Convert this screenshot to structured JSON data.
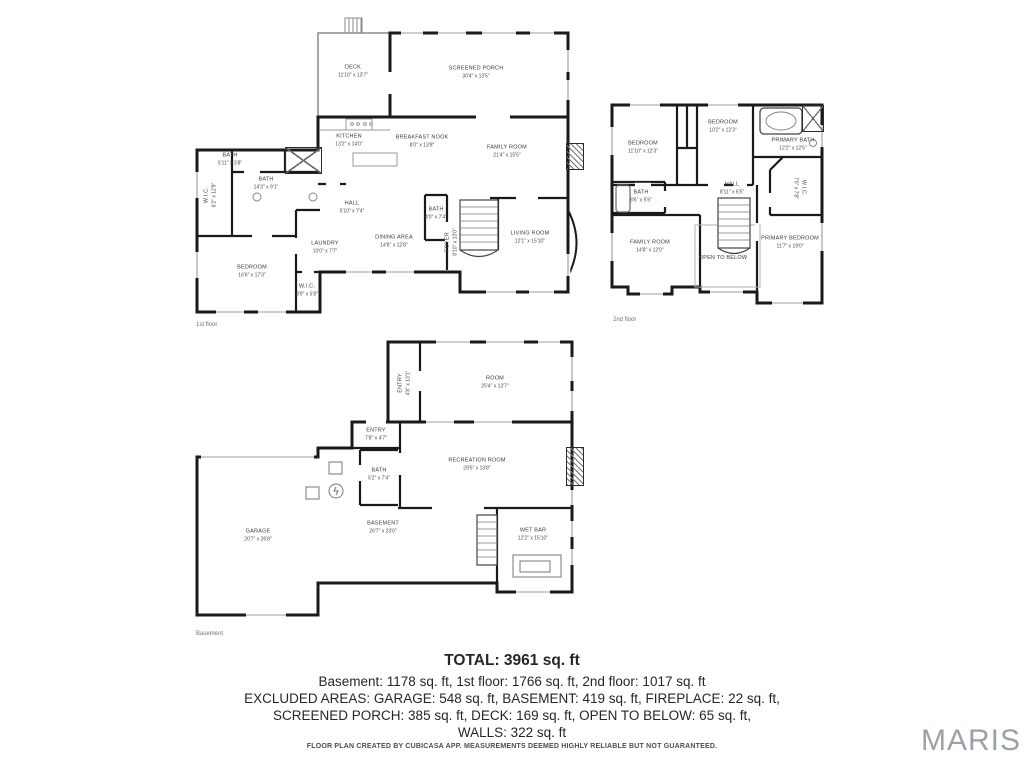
{
  "floors": [
    {
      "label": "1st floor",
      "rooms": [
        {
          "name": "DECK",
          "dims": "11'10\" x 13'7\""
        },
        {
          "name": "SCREENED PORCH",
          "dims": "30'4\" x 13'5\""
        },
        {
          "name": "KITCHEN",
          "dims": "13'2\" x 14'0\""
        },
        {
          "name": "BREAKFAST NOOK",
          "dims": "8'0\" x 13'8\""
        },
        {
          "name": "FAMILY ROOM",
          "dims": "21'4\" x 15'5\""
        },
        {
          "name": "BATH",
          "dims": "5'11\" x 3'8\""
        },
        {
          "name": "BATH",
          "dims": "14'3\" x 9'1\""
        },
        {
          "name": "W.I.C.",
          "dims": "6'2\" x 12'9\""
        },
        {
          "name": "HALL",
          "dims": "5'10\" x 7'4\""
        },
        {
          "name": "LAUNDRY",
          "dims": "10'0\" x 7'7\""
        },
        {
          "name": "DINING AREA",
          "dims": "14'8\" x 12'8\""
        },
        {
          "name": "BATH",
          "dims": "4'0\" x 7'4\""
        },
        {
          "name": "FOYER",
          "dims": "8'10\" x 13'0\""
        },
        {
          "name": "LIVING ROOM",
          "dims": "12'1\" x 15'10\""
        },
        {
          "name": "BEDROOM",
          "dims": "16'6\" x 17'3\""
        },
        {
          "name": "W.I.C.",
          "dims": "3'9\" x 5'8\""
        }
      ]
    },
    {
      "label": "2nd floor",
      "rooms": [
        {
          "name": "BEDROOM",
          "dims": "11'10\" x 12'3\""
        },
        {
          "name": "BEDROOM",
          "dims": "10'2\" x 12'3\""
        },
        {
          "name": "PRIMARY BATH",
          "dims": "12'2\" x 12'5\""
        },
        {
          "name": "W.I.C.",
          "dims": "7'0\" x 7'8\""
        },
        {
          "name": "BATH",
          "dims": "8'6\" x 5'5\""
        },
        {
          "name": "HALL",
          "dims": "8'11\" x 6'5\""
        },
        {
          "name": "FAMILY ROOM",
          "dims": "14'8\" x 12'0\""
        },
        {
          "name": "OPEN TO BELOW",
          "dims": ""
        },
        {
          "name": "PRIMARY BEDROOM",
          "dims": "11'7\" x 19'0\""
        }
      ]
    },
    {
      "label": "Basement",
      "rooms": [
        {
          "name": "ENTRY",
          "dims": "4'8\" x 13'1\""
        },
        {
          "name": "ROOM",
          "dims": "25'4\" x 13'7\""
        },
        {
          "name": "ENTRY",
          "dims": "7'8\" x 4'7\""
        },
        {
          "name": "BATH",
          "dims": "5'2\" x 7'4\""
        },
        {
          "name": "RECREATION ROOM",
          "dims": "29'5\" x 13'8\""
        },
        {
          "name": "GARAGE",
          "dims": "20'7\" x 26'8\""
        },
        {
          "name": "BASEMENT",
          "dims": "26'7\" x 23'0\""
        },
        {
          "name": "WET BAR",
          "dims": "12'2\" x 15'10\""
        }
      ]
    }
  ],
  "summary": {
    "total": "TOTAL: 3961 sq. ft",
    "line1": "Basement: 1178 sq. ft, 1st floor: 1766 sq. ft, 2nd floor: 1017 sq. ft",
    "line2": "EXCLUDED AREAS: GARAGE: 548 sq. ft, BASEMENT: 419 sq. ft, FIREPLACE: 22 sq. ft,",
    "line3": "SCREENED PORCH: 385 sq. ft, DECK: 169 sq. ft, OPEN TO BELOW: 65 sq. ft,",
    "line4": "WALLS: 322 sq. ft"
  },
  "disclaimer": "FLOOR PLAN CREATED BY CUBICASA APP. MEASUREMENTS DEEMED HIGHLY RELIABLE BUT NOT GUARANTEED.",
  "logo": "MARIS",
  "colors": {
    "wall": "#1a1a1a",
    "logo": "#9aa1a8"
  }
}
